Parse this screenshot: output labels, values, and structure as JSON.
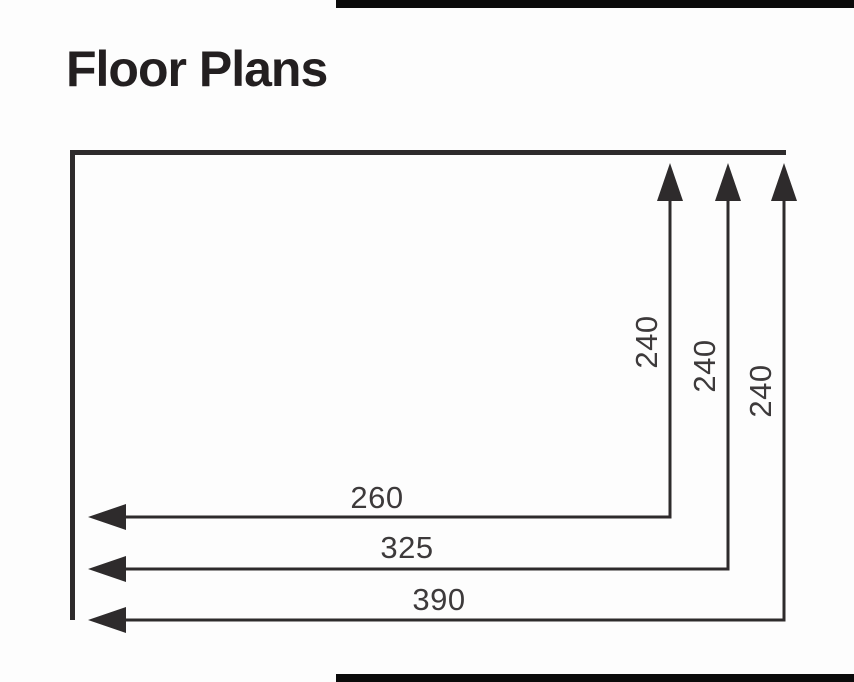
{
  "page": {
    "title": "Floor Plans"
  },
  "colors": {
    "bg": "#fdfdfd",
    "bar": "#0b0b0b",
    "title": "#231f20",
    "line": "#2e2b2c",
    "text": "#3d3a3b"
  },
  "diagram": {
    "type": "floor-plan-dimensions",
    "dimensions": {
      "vertical": [
        {
          "label": "240"
        },
        {
          "label": "240"
        },
        {
          "label": "240"
        }
      ],
      "horizontal": [
        {
          "label": "260"
        },
        {
          "label": "325"
        },
        {
          "label": "390"
        }
      ]
    }
  }
}
